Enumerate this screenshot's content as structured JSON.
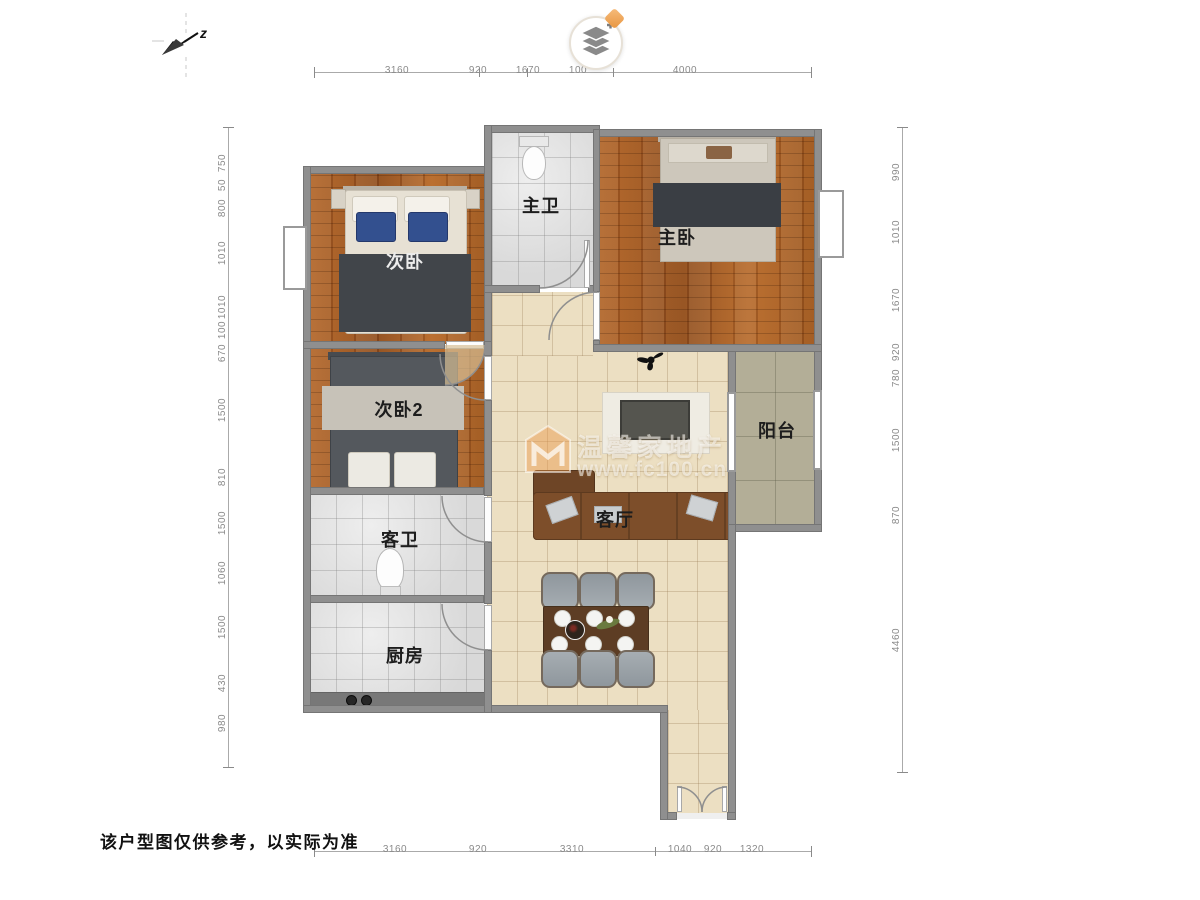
{
  "header": {
    "compass_label": "z",
    "icons": {
      "compass": "north-arrow",
      "layers_control": "map-layers",
      "badge": "orange-diamond"
    }
  },
  "rooms": {
    "bed2": {
      "label": "次卧"
    },
    "master_bath": {
      "label": "主卫"
    },
    "master": {
      "label": "主卧"
    },
    "bed3": {
      "label": "次卧2"
    },
    "guest_bath": {
      "label": "客卫"
    },
    "kitchen": {
      "label": "厨房"
    },
    "living": {
      "label": "客厅"
    },
    "balcony": {
      "label": "阳台"
    }
  },
  "dims": {
    "top": [
      "3160",
      "920",
      "1670",
      "100",
      "4000"
    ],
    "bottom": [
      "3160",
      "920",
      "3310",
      "1040",
      "920",
      "1320"
    ],
    "left": [
      "750",
      "50",
      "800",
      "1010",
      "1010",
      "100",
      "670",
      "1500",
      "810",
      "1500",
      "1060",
      "1500",
      "430",
      "980"
    ],
    "right": [
      "990",
      "1010",
      "1670",
      "920",
      "780",
      "1500",
      "870",
      "4460"
    ]
  },
  "watermark": {
    "brand": "温馨家地产",
    "url": "www.fc100.cn"
  },
  "footer": {
    "disclaimer": "该户型图仅供参考，以实际为准"
  },
  "colors": {
    "wall": "#8f8f8f",
    "wood_floor": "#a65d26",
    "living_floor": "#ecdfc2",
    "balcony_floor": "#b3ae97",
    "bath_tile": "#e3e3e3",
    "accent_orange": "#f0a95c",
    "bed_band_dark": "#3a3e44",
    "sofa_brown": "#7d4e2a"
  }
}
